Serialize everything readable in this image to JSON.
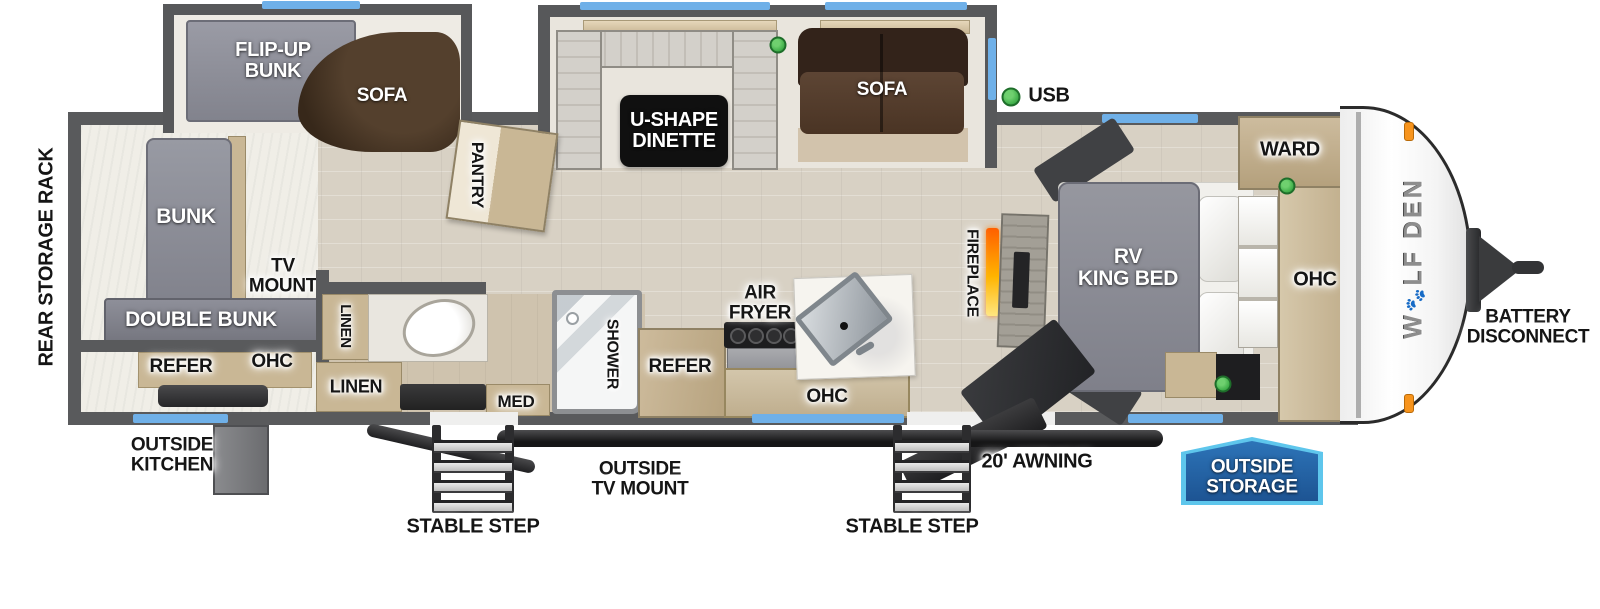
{
  "labels": {
    "rear_storage_rack": "REAR STORAGE RACK",
    "flip_up_bunk": "FLIP-UP\nBUNK",
    "sofa_bunk_slide": "SOFA",
    "u_shape_dinette": "U-SHAPE\nDINETTE",
    "sofa_main_slide": "SOFA",
    "usb": "USB",
    "pantry": "PANTRY",
    "bunk": "BUNK",
    "double_bunk": "DOUBLE BUNK",
    "tv_mount": "TV\nMOUNT",
    "refer_outside_kitchen": "REFER",
    "ohc_outside_kitchen": "OHC",
    "outside_kitchen": "OUTSIDE\nKITCHEN",
    "linen_upper": "LINEN",
    "linen_lower": "LINEN",
    "med": "MED",
    "shower": "SHOWER",
    "refer_kitchen": "REFER",
    "air_fryer": "AIR\nFRYER",
    "ohc_kitchen": "OHC",
    "fireplace": "FIREPLACE",
    "rv_king_bed": "RV\nKING BED",
    "ward": "WARD",
    "ohc_bedroom": "OHC",
    "stable_step_left": "STABLE STEP",
    "stable_step_right": "STABLE STEP",
    "outside_tv_mount": "OUTSIDE\nTV MOUNT",
    "awning": "20' AWNING",
    "outside_storage": "OUTSIDE\nSTORAGE",
    "battery_disconnect": "BATTERY\nDISCONNECT"
  },
  "brand": {
    "logo_part1": "W",
    "logo_paw_icon": "🐾",
    "logo_part2": "LF DEN"
  },
  "colors": {
    "wall": "#595a5c",
    "window_blue": "#6fb0e8",
    "usb_green": "#3fae49",
    "storage_badge_fill": "#2368ad",
    "storage_badge_border": "#5ec6ec",
    "fireplace_orange": "#ff7a00",
    "floor_wood": "#d8d1c4",
    "cabinet_tan": "#c9b795",
    "mattress_gray": "#8d8e97",
    "sofa_brown": "#4a3424"
  }
}
